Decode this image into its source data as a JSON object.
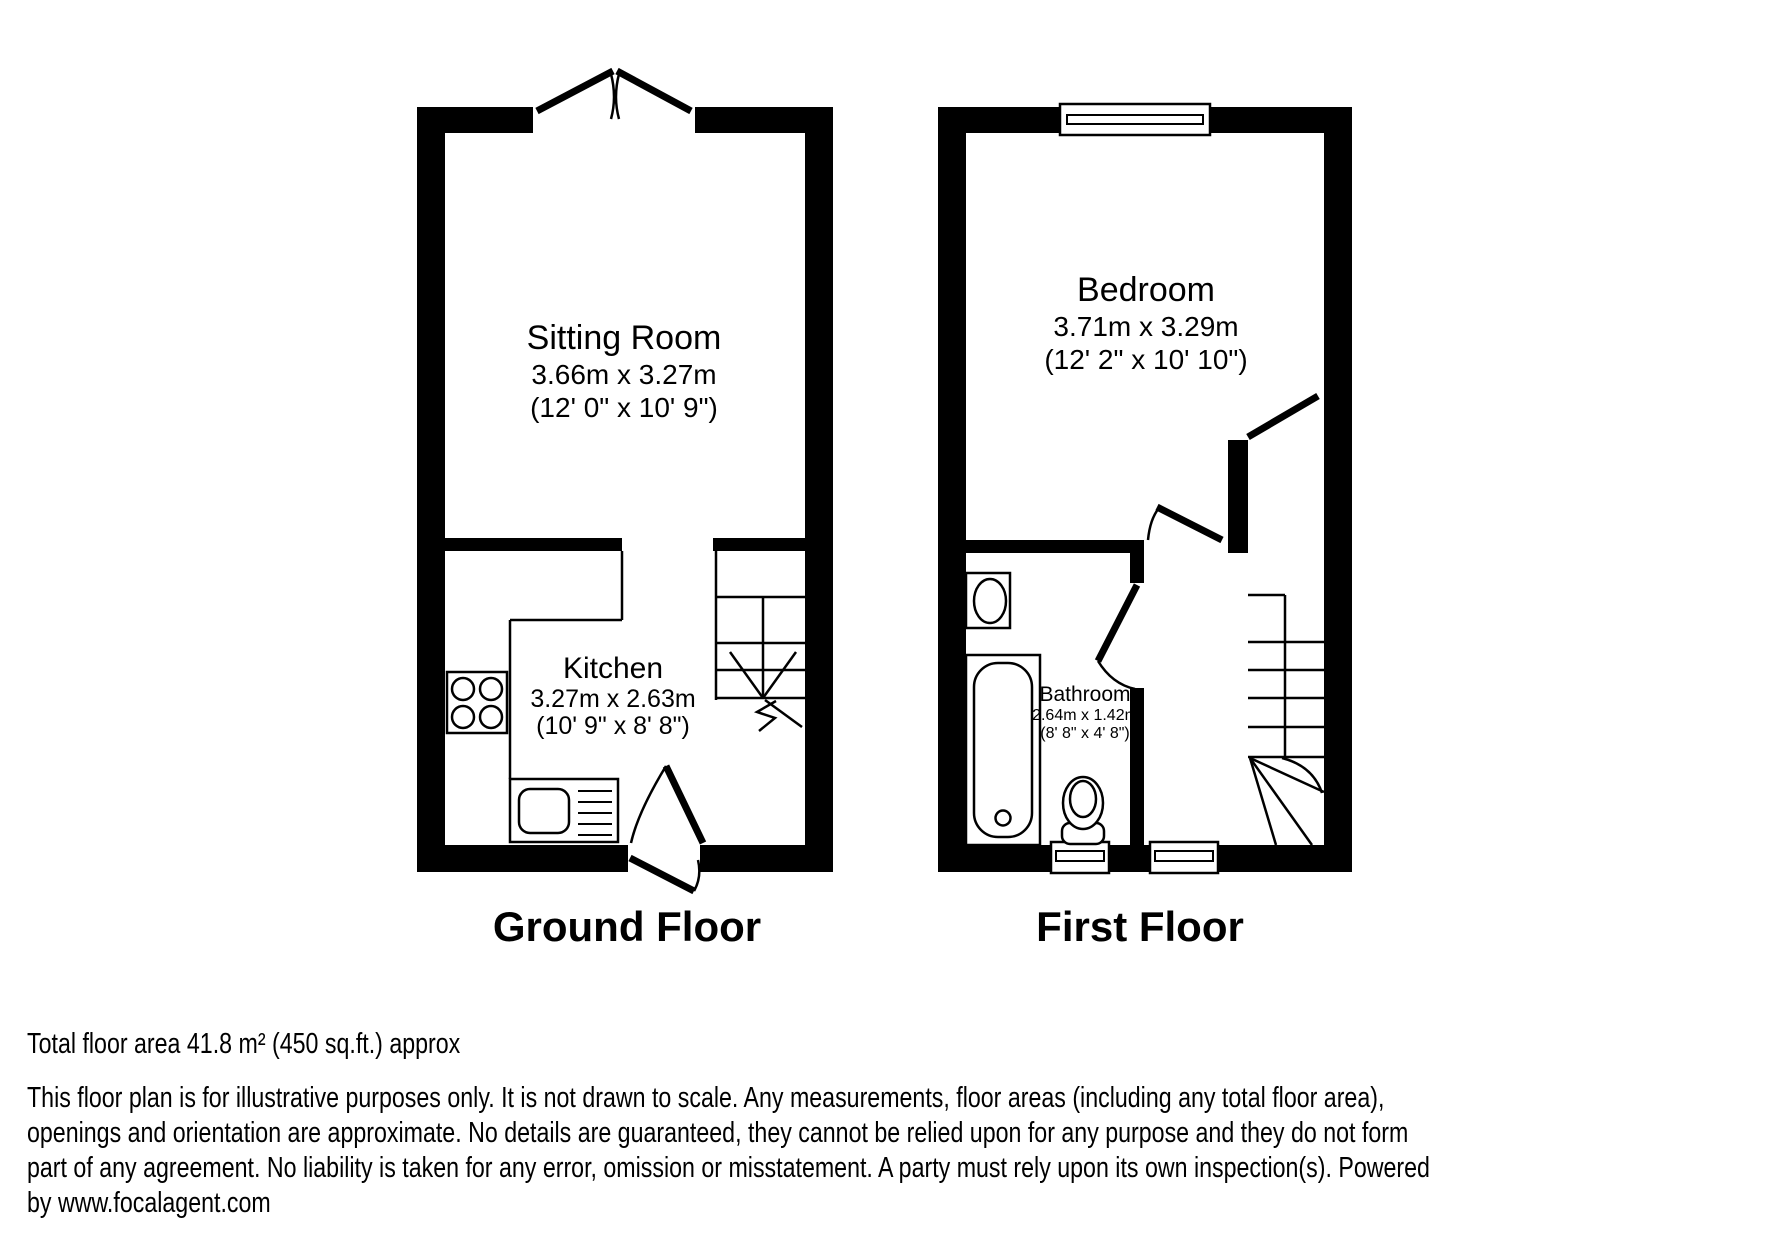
{
  "colors": {
    "wall": "#000000",
    "background": "#ffffff"
  },
  "floors": [
    {
      "id": "ground-floor",
      "label": "Ground Floor",
      "rooms": [
        {
          "name": "Sitting Room",
          "dimensions_metric": "3.66m x 3.27m",
          "dimensions_imperial": "(12' 0\" x 10' 9\")"
        },
        {
          "name": "Kitchen",
          "dimensions_metric": "3.27m x 2.63m",
          "dimensions_imperial": "(10' 9\" x 8' 8\")"
        }
      ],
      "features": [
        "french-doors",
        "staircase",
        "kitchen-hob",
        "kitchen-sink",
        "front-door",
        "interior-door"
      ]
    },
    {
      "id": "first-floor",
      "label": "First Floor",
      "rooms": [
        {
          "name": "Bedroom",
          "dimensions_metric": "3.71m x 3.29m",
          "dimensions_imperial": "(12' 2\" x 10' 10\")"
        },
        {
          "name": "Bathroom",
          "dimensions_metric": "2.64m x 1.42m",
          "dimensions_imperial": "(8' 8\" x 4' 8\")"
        }
      ],
      "features": [
        "window",
        "staircase-winder",
        "basin",
        "bathtub",
        "toilet",
        "bathroom-door",
        "bedroom-door",
        "landing-door"
      ]
    }
  ],
  "footer": {
    "total_area": "Total floor area 41.8 m² (450 sq.ft.) approx",
    "disclaimer_lines": [
      "This floor plan is for illustrative purposes only. It is not drawn to scale. Any measurements, floor areas (including any total floor area),",
      "openings and orientation are approximate. No details are guaranteed, they cannot be relied upon for any purpose and they do not form",
      "part of any agreement. No liability is taken for any error, omission or misstatement. A party must rely upon its own inspection(s). Powered",
      "by www.focalagent.com"
    ],
    "disclaimer_full": "This floor plan is for illustrative purposes only. It is not drawn to scale. Any measurements, floor areas (including any total floor area), openings and orientation are approximate. No details are guaranteed, they cannot be relied upon for any purpose and they do not form part of any agreement. No liability is taken for any error, omission or misstatement. A party must rely upon its own inspection(s). Powered by www.focalagent.com"
  }
}
